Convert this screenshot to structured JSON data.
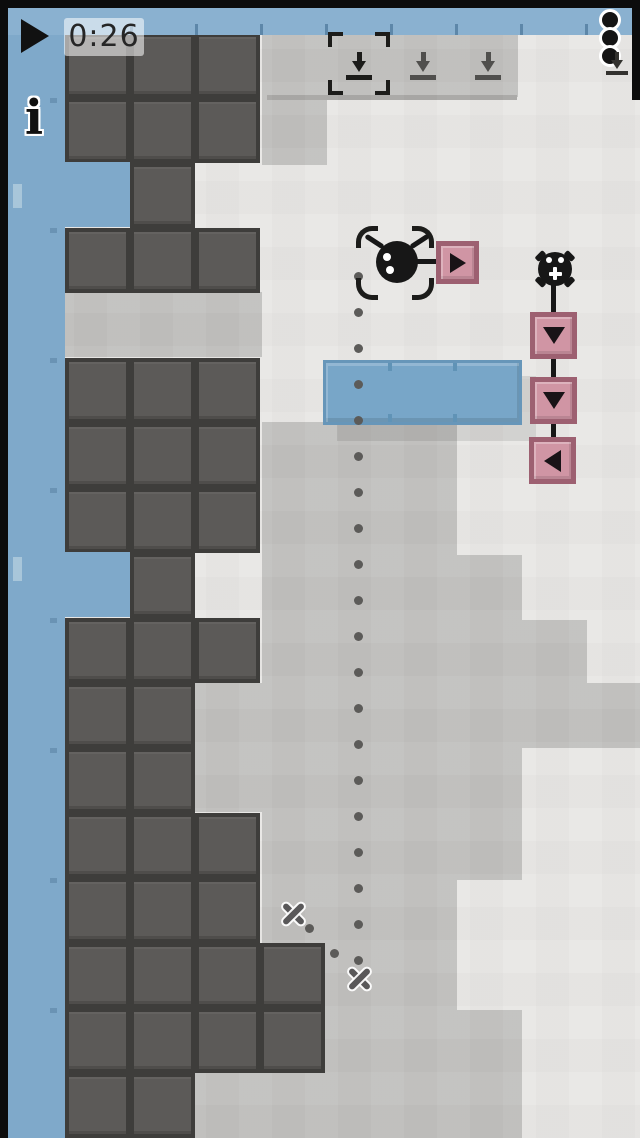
{
  "ui": {
    "top_bar": {
      "timer_label": "0:26"
    },
    "info_label": "i"
  },
  "colors": {
    "frame": "#0c0c0c",
    "bar_blue": "#8ab1d0",
    "wall_blue": "#7fa9ca",
    "wall_nub": "#a8c6da",
    "wall_tick": "#6a93b4",
    "bar_tick": "#5d87a9",
    "bg_light": "#e9e8e6",
    "fog": "#c3c2c0",
    "fog_edge": "#a9a8a6",
    "block_border": "#3e3d3b",
    "block_fill": "#5c5a58",
    "platform_fill": "#78a6c8",
    "platform_border": "#6796b9",
    "platform_tick": "#6093b6",
    "pink_fill": "#d095a4",
    "pink_border": "#9d6071",
    "icon_dark": "#1c1c1a",
    "icon_mid": "#504f4d",
    "icon_corner": "#33322f",
    "dot": "#5c5b59",
    "xmark": "#595859",
    "timer_text": "#262626",
    "glyph_black": "#191317"
  },
  "level": {
    "grid": {
      "origin_x": 65,
      "origin_y": 33,
      "cell": 65
    },
    "block_rows": [
      {
        "row": 0,
        "cols": [
          0,
          1,
          2
        ]
      },
      {
        "row": 1,
        "cols": [
          0,
          1,
          2
        ]
      },
      {
        "row": 2,
        "cols": [
          1
        ]
      },
      {
        "row": 3,
        "cols": [
          0,
          1,
          2
        ]
      },
      {
        "row": 5,
        "cols": [
          0,
          1,
          2
        ]
      },
      {
        "row": 6,
        "cols": [
          0,
          1,
          2
        ]
      },
      {
        "row": 7,
        "cols": [
          0,
          1,
          2
        ]
      },
      {
        "row": 8,
        "cols": [
          1
        ]
      },
      {
        "row": 9,
        "cols": [
          0,
          1,
          2
        ]
      },
      {
        "row": 10,
        "cols": [
          0,
          1
        ]
      },
      {
        "row": 11,
        "cols": [
          0,
          1
        ]
      },
      {
        "row": 12,
        "cols": [
          0,
          1,
          2
        ]
      },
      {
        "row": 13,
        "cols": [
          0,
          1,
          2
        ]
      },
      {
        "row": 14,
        "cols": [
          0,
          1,
          2,
          3
        ]
      },
      {
        "row": 15,
        "cols": [
          0,
          1,
          2,
          3
        ]
      },
      {
        "row": 16,
        "cols": [
          0,
          1
        ]
      }
    ],
    "fog_rects": [
      [
        262,
        35,
        256,
        62
      ],
      [
        262,
        97,
        65,
        68
      ],
      [
        65,
        292,
        197,
        65
      ],
      [
        262,
        422,
        195,
        133
      ],
      [
        262,
        555,
        260,
        65
      ],
      [
        262,
        620,
        325,
        63
      ],
      [
        262,
        683,
        378,
        65
      ],
      [
        195,
        683,
        67,
        129
      ],
      [
        262,
        748,
        260,
        132
      ],
      [
        262,
        880,
        195,
        130
      ],
      [
        262,
        1010,
        260,
        128
      ],
      [
        195,
        1072,
        67,
        66
      ]
    ],
    "fog_edge_rect": [
      267,
      95,
      250,
      5
    ],
    "wall": {
      "x": 8,
      "y": 8,
      "w": 57,
      "h": 1130,
      "notches": [
        [
          8,
          162,
          122,
          65
        ],
        [
          8,
          552,
          122,
          65
        ]
      ],
      "nubs": [
        [
          13,
          184,
          9,
          24
        ],
        [
          13,
          557,
          9,
          24
        ]
      ],
      "ticks_y": [
        98,
        228,
        358,
        488,
        618,
        748,
        878,
        1008
      ]
    },
    "right_wall": [
      632,
      0,
      8,
      100
    ],
    "bar_ticks_x": [
      130,
      195,
      260,
      325,
      390,
      455,
      520,
      585
    ],
    "platform": {
      "x": 323,
      "y": 360,
      "w": 199,
      "h": 65,
      "tick_offsets": [
        62,
        127
      ]
    },
    "path": {
      "main": {
        "x": 358,
        "y_start": 276,
        "step": 36,
        "count": 20
      },
      "branch_dots": [
        [
          309,
          928
        ],
        [
          334,
          953
        ]
      ],
      "x_marks": [
        [
          293,
          913
        ],
        [
          359,
          978
        ]
      ]
    },
    "robot": {
      "bracket": {
        "x": 356,
        "y": 226,
        "w": 78,
        "h": 74
      },
      "body": {
        "cx": 397,
        "cy": 262,
        "r": 21
      },
      "connector": {
        "x": 414,
        "y": 259,
        "len": 26
      },
      "action_button": {
        "x": 436,
        "y": 241,
        "size": 43,
        "glyph": "right"
      }
    },
    "chain": {
      "sprocket": {
        "cx": 555,
        "cy": 269,
        "r": 17
      },
      "line": {
        "x": 551,
        "y1": 278,
        "y2": 462,
        "w": 5
      },
      "buttons": [
        {
          "x": 530,
          "y": 312,
          "size": 47,
          "glyph": "down"
        },
        {
          "x": 530,
          "y": 377,
          "size": 47,
          "glyph": "down"
        },
        {
          "x": 529,
          "y": 437,
          "size": 47,
          "glyph": "left"
        }
      ]
    },
    "toolbar": {
      "icons": [
        {
          "cx": 359,
          "selected": true
        },
        {
          "cx": 423,
          "selected": false
        },
        {
          "cx": 488,
          "selected": false
        }
      ],
      "icon_top": 52,
      "bracket": {
        "x": 328,
        "y": 32,
        "w": 62,
        "h": 63
      },
      "corner_icon": {
        "x": 606,
        "y": 52
      }
    },
    "hud": {
      "play_button": {
        "x": 21,
        "y": 19,
        "w": 30,
        "h": 34
      },
      "timer_box": {
        "x": 64,
        "y": 18,
        "w": 80,
        "h": 38
      },
      "kebab": {
        "cx": 610,
        "ys": [
          20,
          38,
          56
        ]
      },
      "info": {
        "x": 14,
        "y": 94,
        "w": 40
      }
    }
  }
}
